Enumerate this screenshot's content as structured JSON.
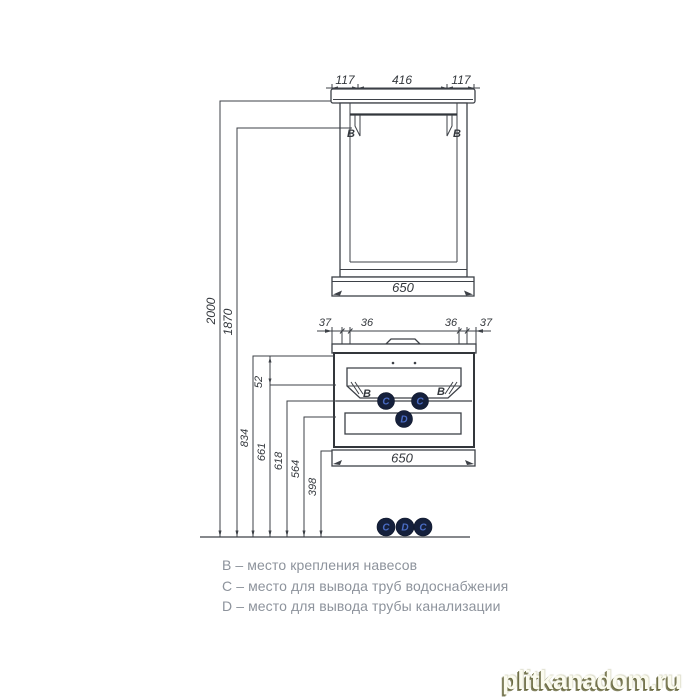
{
  "mirror": {
    "dim_top_left": "117",
    "dim_top_center": "416",
    "dim_top_right": "117",
    "dim_width": "650",
    "mount_left": "B",
    "mount_right": "B"
  },
  "vanity": {
    "dim_top": [
      "37",
      "36",
      "36",
      "37"
    ],
    "dim_offset": "52",
    "dim_width": "650",
    "mount_left": "B",
    "mount_right": "B",
    "supply_left": "C",
    "supply_right": "C",
    "drain": "D"
  },
  "heights": {
    "h2000": "2000",
    "h1870": "1870",
    "h834": "834",
    "h661": "661",
    "h618": "618",
    "h564": "564",
    "h398": "398"
  },
  "floor_markers": [
    "C",
    "D",
    "C"
  ],
  "legend": {
    "items": [
      {
        "text": "B – место крепления навесов"
      },
      {
        "text": "C – место для вывода труб водоснабжения"
      },
      {
        "text": "D – место для вывода трубы канализации"
      }
    ]
  },
  "watermark": {
    "text": "plitkanadom.ru"
  },
  "colors": {
    "line": "#3d4147",
    "dim_text": "#34383d",
    "legend_text": "#8d939c",
    "marker_fill": "#15203c",
    "marker_letter": "#4a6cc4",
    "watermark_shadow": "#68683e"
  }
}
